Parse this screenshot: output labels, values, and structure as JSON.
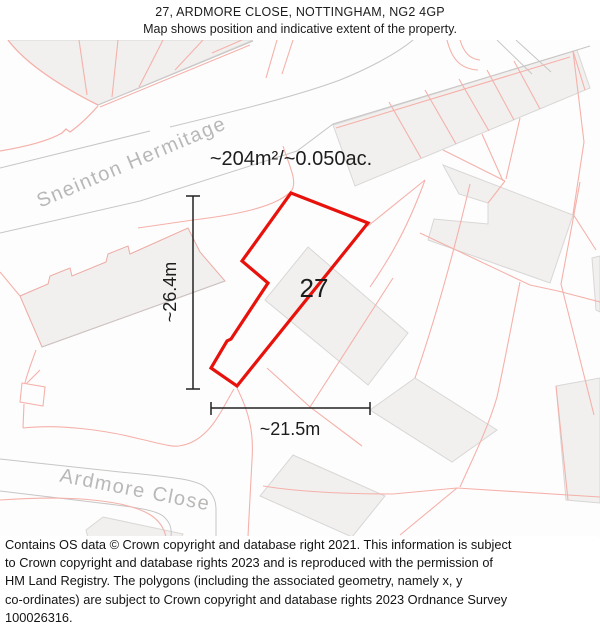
{
  "header": {
    "title": "27, ARDMORE CLOSE, NOTTINGHAM, NG2 4GP",
    "subtitle": "Map shows position and indicative extent of the property."
  },
  "map": {
    "area_label": "~204m²/~0.050ac.",
    "plot_number": "27",
    "width_label": "~21.5m",
    "height_label": "~26.4m",
    "streets": {
      "sneinton": "Sneinton Hermitage",
      "ardmore": "Ardmore Close"
    },
    "colors": {
      "property_outline": "#e8120c",
      "parcel_line": "#f5b1aa",
      "building_fill": "#f1f0ef",
      "building_stroke": "#d8d7d6",
      "road_line": "#c7c6c5",
      "street_label": "#b9b8b7",
      "measurement_text": "#1d1d1d"
    }
  },
  "footer": {
    "lines": [
      "Contains OS data © Crown copyright and database right 2021. This information is subject",
      "to Crown copyright and database rights 2023 and is reproduced with the permission of",
      "HM Land Registry. The polygons (including the associated geometry, namely x, y",
      "co-ordinates) are subject to Crown copyright and database rights 2023 Ordnance Survey",
      "100026316."
    ]
  }
}
